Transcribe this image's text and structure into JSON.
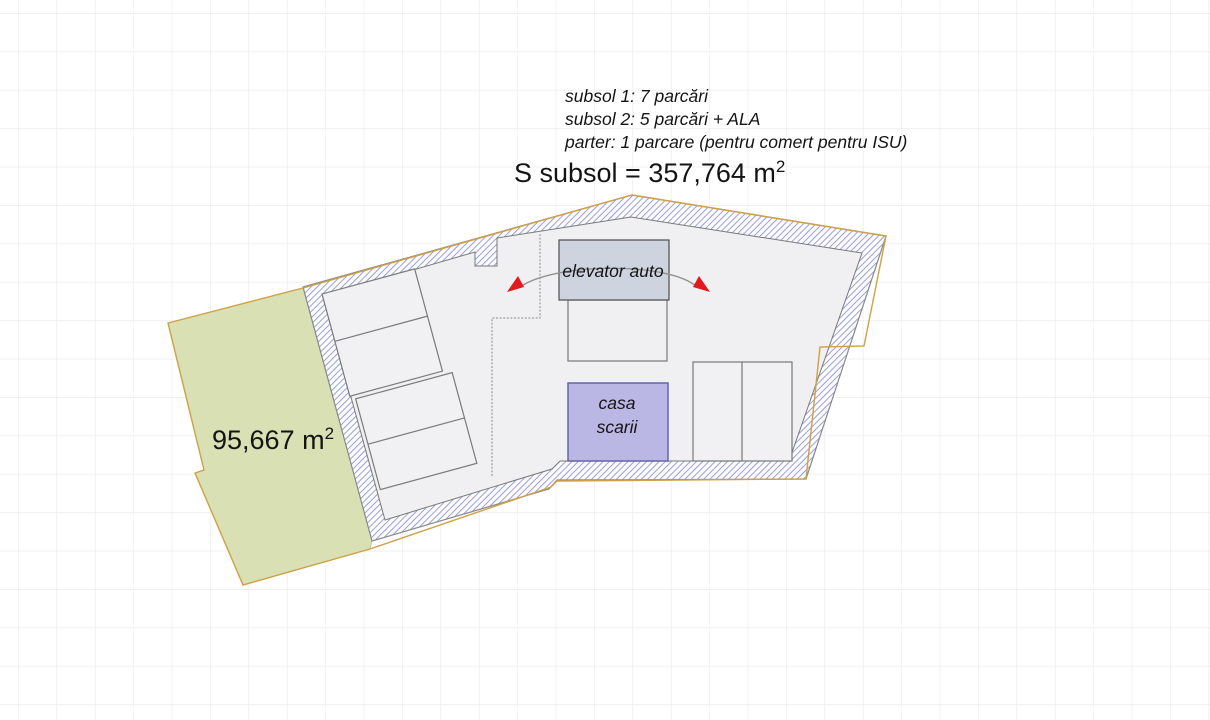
{
  "annotations": {
    "line1": "subsol 1: 7 parcări",
    "line2": "subsol 2: 5 parcări + ALA",
    "line3": "parter: 1 parcare (pentru comert pentru ISU)"
  },
  "subsol_area": {
    "text": "S subsol = 357,764 m",
    "sup": "2"
  },
  "green_area": {
    "text": "95,667 m",
    "sup": "2"
  },
  "elevator": {
    "label": "elevator auto"
  },
  "stairs": {
    "line1": "casa",
    "line2": "scarii"
  },
  "colors": {
    "grid": "#ececee",
    "green_fill": "#d9e0b4",
    "property_line": "#cfa045",
    "hatch_stripe": "#7d84c6",
    "hatch_bg": "#fbfbfd",
    "wall_edge": "#8a8a8a",
    "floor_fill": "#f0f0f2",
    "stall_fill": "#f1f1f3",
    "stall_stroke": "#7a7a7a",
    "elevator_fill": "#cdd4df",
    "elevator_stroke": "#4d4d4d",
    "stairs_fill": "#bab7e5",
    "stairs_stroke": "#6365ad",
    "arrow_red": "#e2191d",
    "arc_gray": "#909090"
  }
}
